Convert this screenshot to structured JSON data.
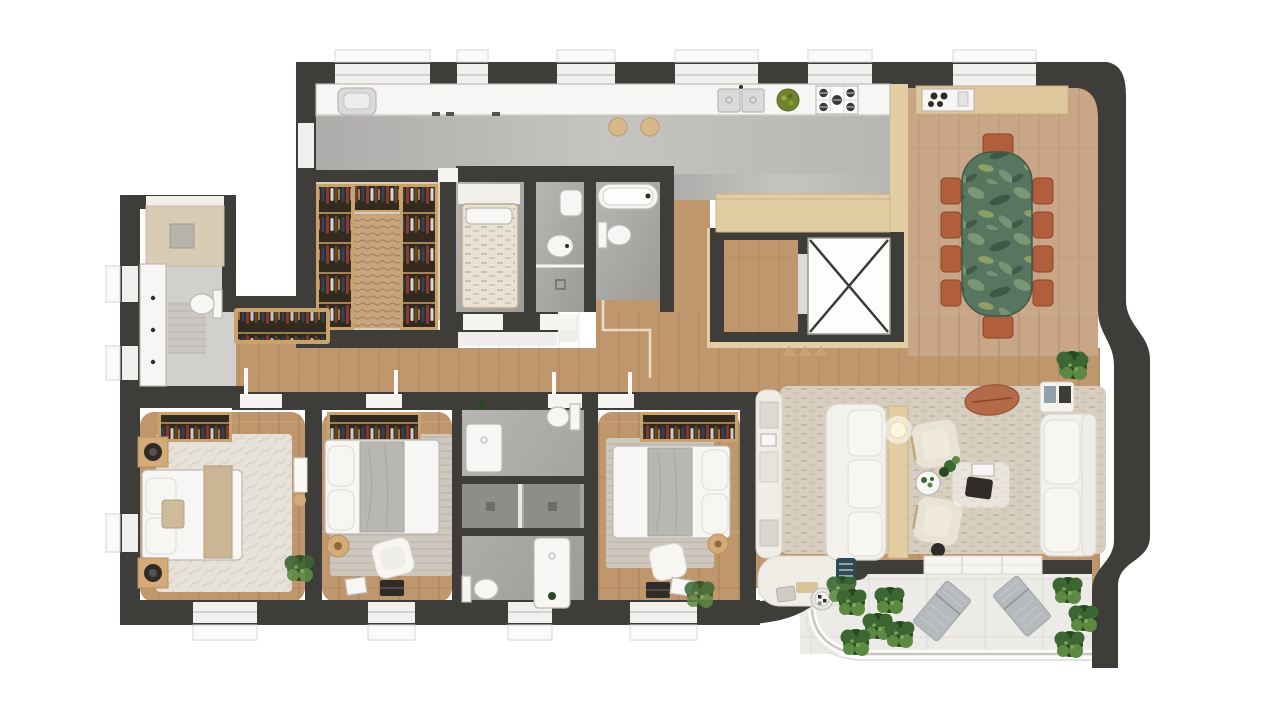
{
  "title": "Apartment floor plan – 3D top-down render",
  "palette": {
    "outside": "#ffffff",
    "wall": "#3f3d3a",
    "windowFill": "#f1f0ee",
    "sill": "#fafaf8",
    "woodFloor": "#c0976d",
    "woodDining": "#c8a687",
    "woodClosetFloor": "#d9cdb8",
    "woodPale": "#e3cda3",
    "woodMid": "#dfc79e",
    "woodSide": "#d3aa78",
    "woodTrim": "#dcc79f",
    "closetWood": "#c9a36b",
    "closetDark": "#32291f",
    "grayKitchenLight": "#cbc9c6",
    "grayKitchenDark": "#b0aeab",
    "grayBathLight": "#b5b3b0",
    "grayBathDark": "#9a9895",
    "grayStall": "#8f8d8a",
    "laundryFloor": "#d2d0cd",
    "laundryBeige": "#d8ccb5",
    "threshold": "#efeeea",
    "fixtureWhite": "#f7f6f4",
    "rugCream": "#e6e2d9",
    "rugStripe": "#cdc7bd",
    "rugTan": "#c7a47d",
    "rugLiving": "#d8cec0",
    "marbleBase": "#57755f",
    "marbleLight": "#8aa682",
    "marbleDark": "#35523f",
    "marbleAccent": "#b9c16a",
    "terracotta": "#b05e3c",
    "pouf": "#b4694a",
    "sofa": "#f2f1ed",
    "sofaShadow": "#d8d5cf",
    "cream": "#e9e3d6",
    "plantDark": "#27491f",
    "plantMid": "#3c6632",
    "plantLight": "#5d8a43",
    "lounger": "#b7babc",
    "rail": "#c8c6c1",
    "balconyFloor": "#edebe7",
    "lampGlow": "#fdf6e3",
    "elevatorX": "#3a3938",
    "stoveDark": "#3a3938",
    "bowlGreen": "#70812f",
    "stoolTan": "#d8b98c",
    "tealBox": "#2e4a52",
    "darkItem": "#2f2c28"
  },
  "plan": {
    "type": "residential-apartment-top-view",
    "rooms": [
      {
        "name": "laundry room"
      },
      {
        "name": "service room"
      },
      {
        "name": "walk-in closet"
      },
      {
        "name": "small bedroom"
      },
      {
        "name": "bathroom with bidet"
      },
      {
        "name": "bathroom with bathtub"
      },
      {
        "name": "kitchen"
      },
      {
        "name": "dining room"
      },
      {
        "name": "elevator hall"
      },
      {
        "name": "elevator"
      },
      {
        "name": "corridor"
      },
      {
        "name": "master bedroom"
      },
      {
        "name": "bedroom 2"
      },
      {
        "name": "bedroom 3"
      },
      {
        "name": "guest toilet"
      },
      {
        "name": "shower rooms"
      },
      {
        "name": "bathroom 3"
      },
      {
        "name": "living room"
      },
      {
        "name": "barbecue nook"
      },
      {
        "name": "balcony terrace"
      }
    ],
    "furniture": {
      "dining": [
        "green marble dining table",
        "10 terracotta chairs",
        "wood sideboard with coffee station",
        "potted plant"
      ],
      "kitchen": [
        "white counter with double sink",
        "gas cooktop",
        "fruit bowl",
        "two bar stools",
        "pale wood island"
      ],
      "living": [
        "white three-seat sofa",
        "wood console with lamp",
        "two cream armchairs",
        "glass coffee table",
        "terracotta pouf",
        "white chaise sofa",
        "magazine table",
        "textured rug",
        "curved shelf unit",
        "round grill"
      ],
      "masterBedroom": [
        "double bed with tan runner",
        "two nightstands with speakers",
        "open wardrobe",
        "cream rug",
        "plant"
      ],
      "bedroom2": [
        "double bed",
        "open wardrobe",
        "striped rug",
        "lounge chair",
        "side table",
        "laptop"
      ],
      "bedroom3": [
        "double bed",
        "open wardrobe",
        "striped rug",
        "pouf",
        "side table",
        "laptop",
        "plant"
      ],
      "balcony": [
        "two metal loungers",
        "planting beds",
        "glass railing"
      ],
      "elevator": [
        "elevator cab marked with X",
        "entry triangles"
      ]
    }
  }
}
